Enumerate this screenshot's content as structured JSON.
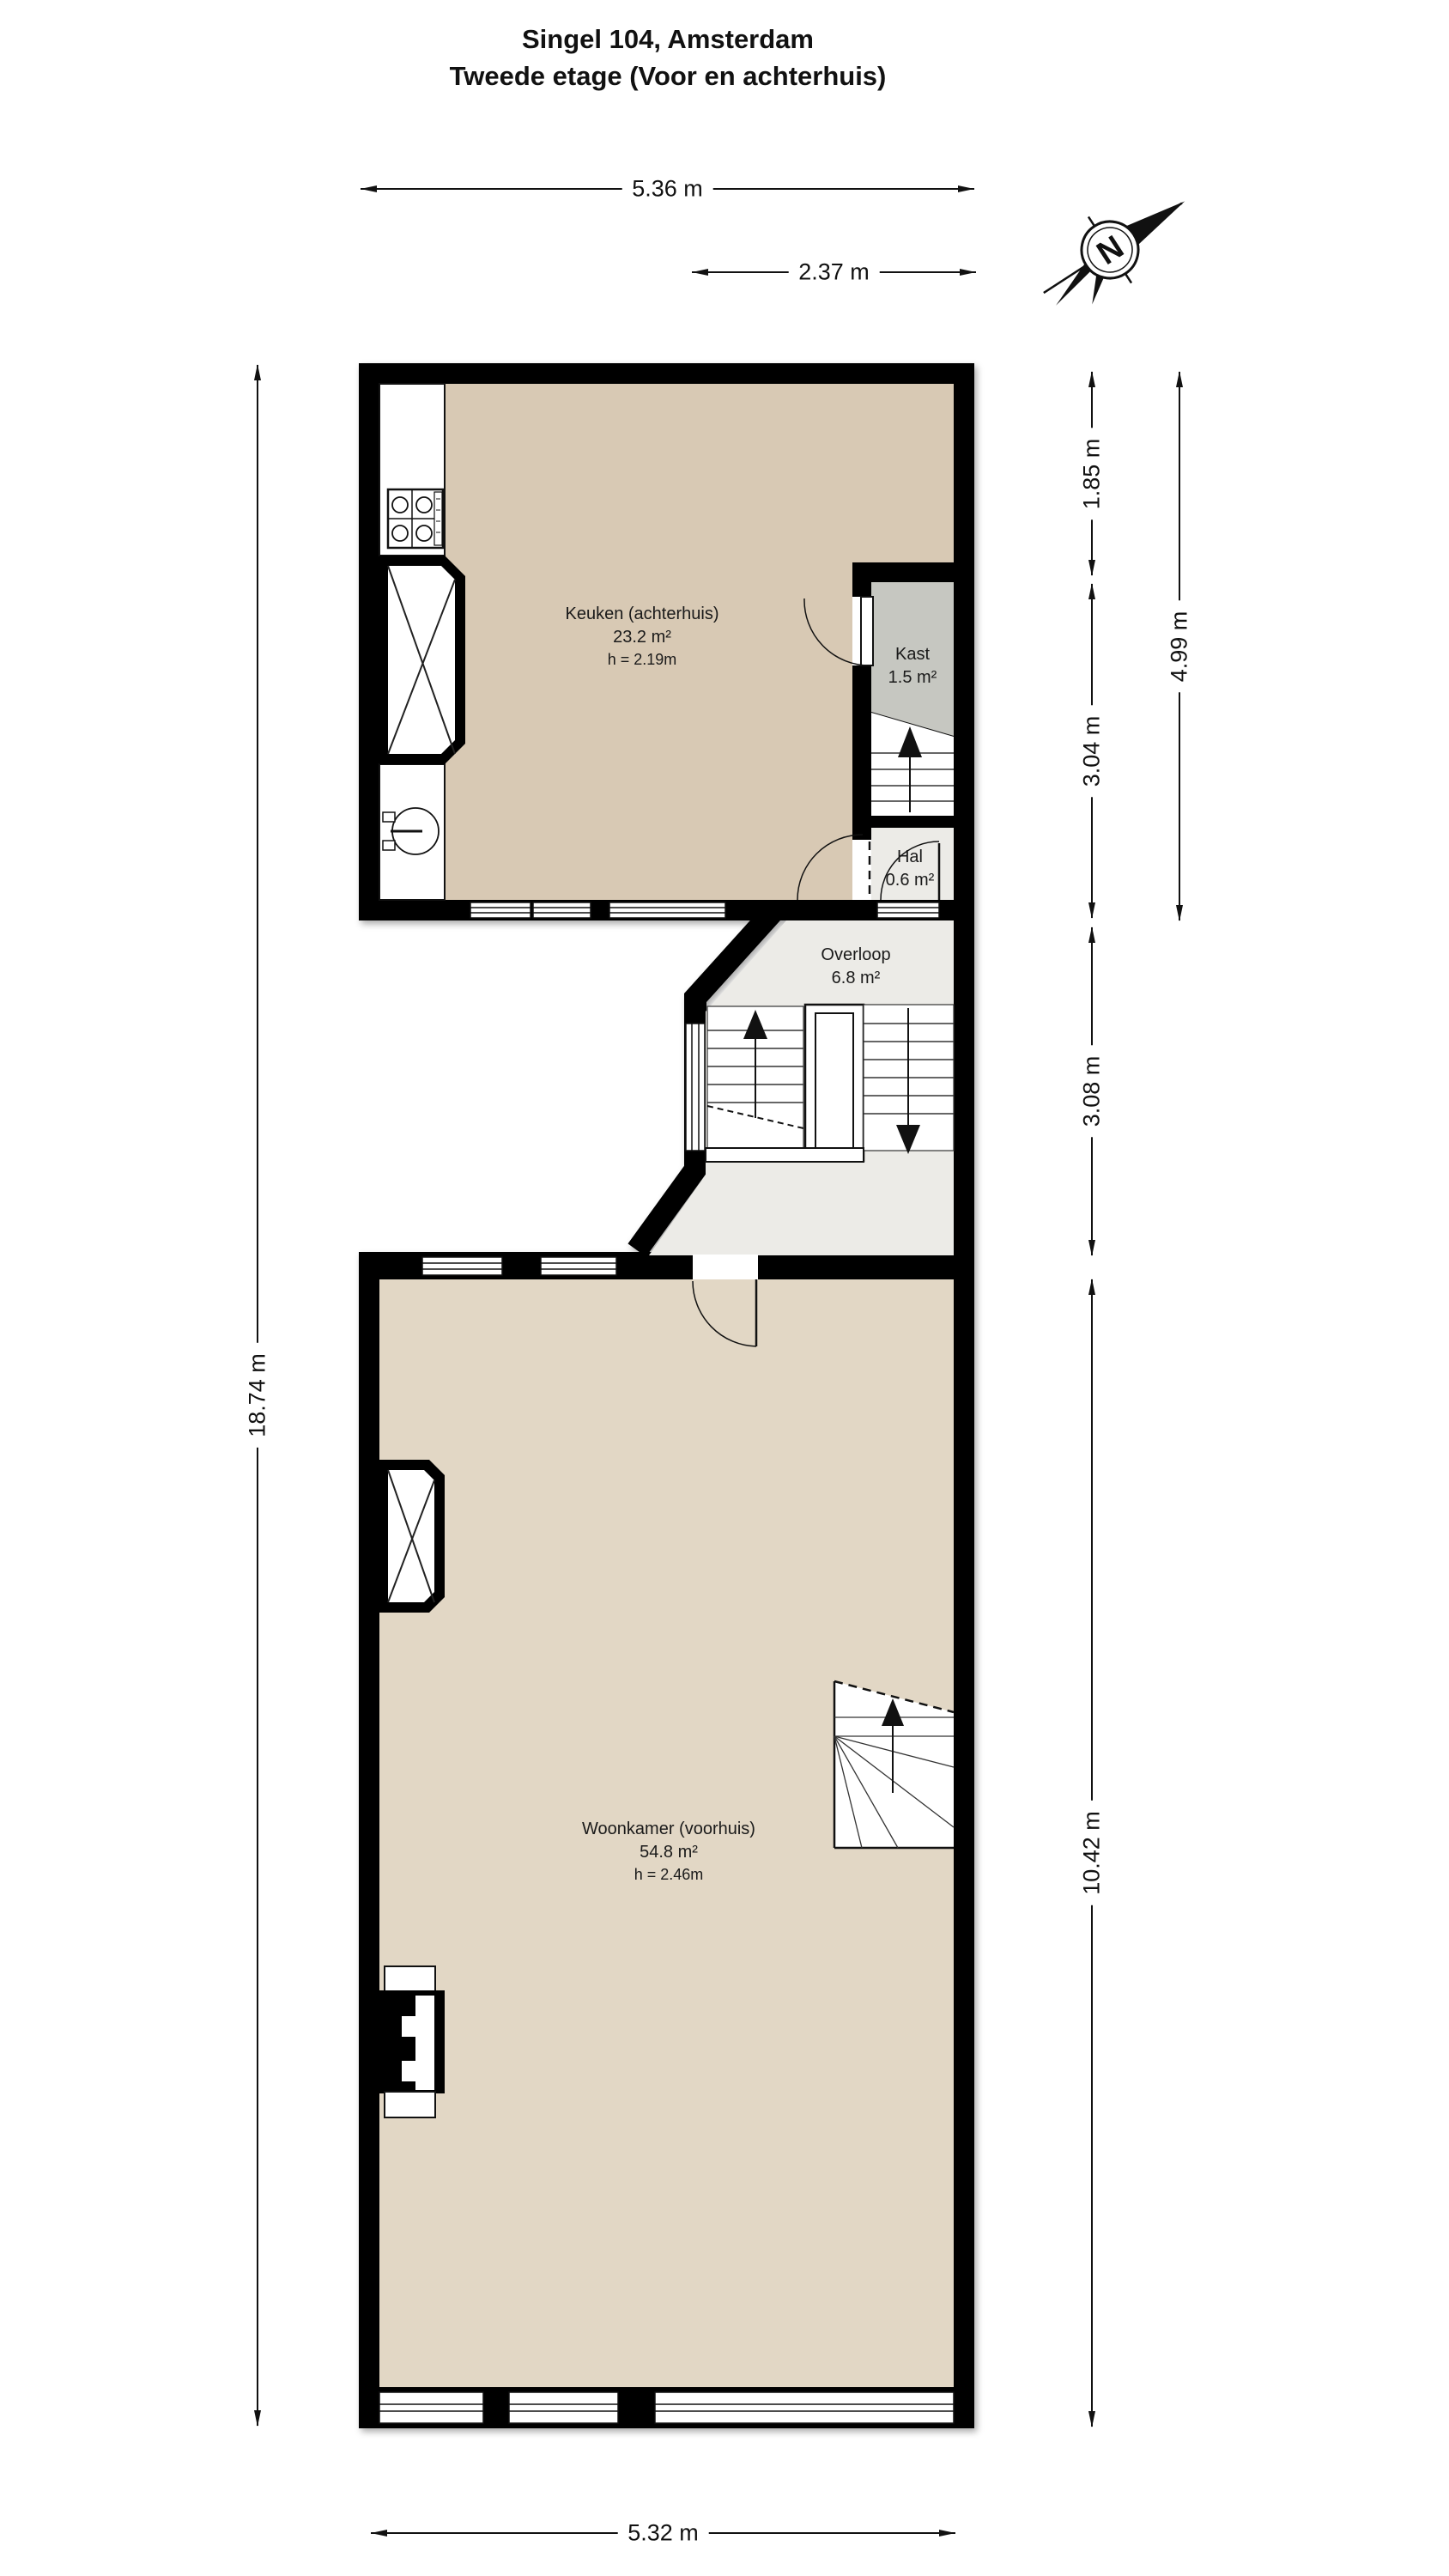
{
  "title": {
    "line1": "Singel 104, Amsterdam",
    "line2": "Tweede etage (Voor en achterhuis)"
  },
  "compass": {
    "label": "N"
  },
  "rooms": {
    "keuken": {
      "name": "Keuken (achterhuis)",
      "area": "23.2 m²",
      "ceiling": "h = 2.19m"
    },
    "kast": {
      "name": "Kast",
      "area": "1.5 m²"
    },
    "hal": {
      "name": "Hal",
      "area": "0.6 m²"
    },
    "overloop": {
      "name": "Overloop",
      "area": "6.8 m²"
    },
    "woonkamer": {
      "name": "Woonkamer (voorhuis)",
      "area": "54.8 m²",
      "ceiling": "h = 2.46m"
    }
  },
  "dimensions": {
    "top_total": "5.36 m",
    "top_partial": "2.37 m",
    "left_total": "18.74 m",
    "right_kitchen_upper": "1.85 m",
    "right_kitchen_lower": "3.04 m",
    "right_kitchen_total": "4.99 m",
    "right_overloop": "3.08 m",
    "right_woonkamer": "10.42 m",
    "bottom_total": "5.32 m"
  },
  "colors": {
    "wall": "#000000",
    "line": "#111111",
    "floor_keuken": "#d8c9b4",
    "floor_woonkamer": "#e2d7c5",
    "floor_kast": "#c6c7c1",
    "floor_hal": "#ecebe7"
  }
}
